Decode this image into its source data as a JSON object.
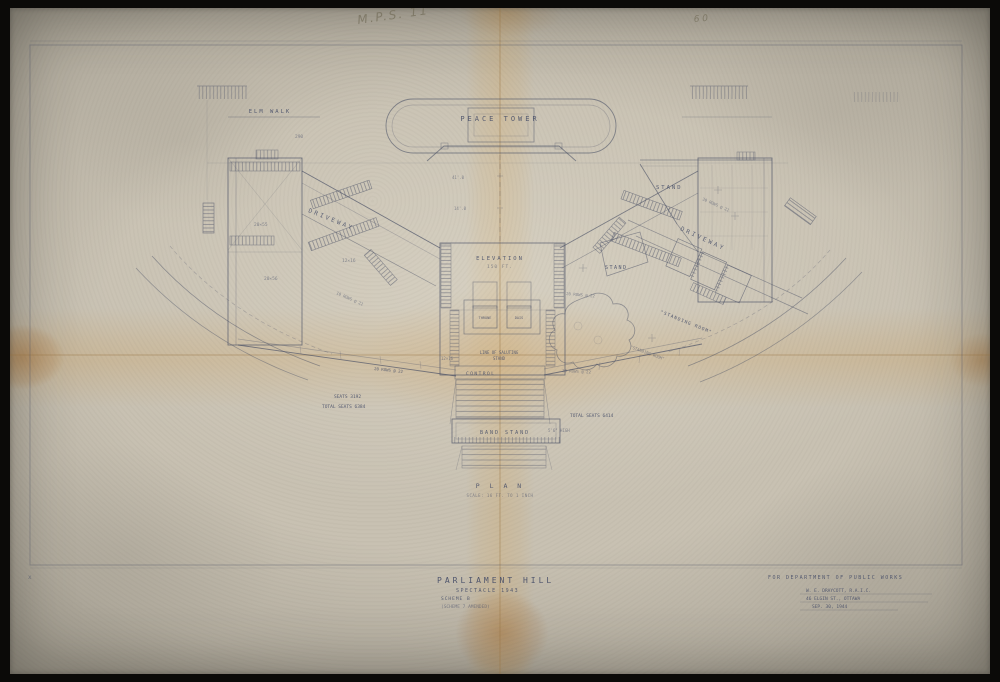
{
  "artifact": {
    "scribble_top": "M.P.S. 11",
    "scribble_top_right": "6 0",
    "x_mark": "x"
  },
  "plan": {
    "peace_tower": "PEACE TOWER",
    "elm_walk": "ELM WALK",
    "ref_290": "290",
    "dim_41": "41'.0",
    "dim_14": "14'.0",
    "elevation": "ELEVATION",
    "elevation_note": "150 FT.",
    "driveway_left": "DRIVEWAY",
    "driveway_right": "DRIVEWAY",
    "stand_right_top": "STAND",
    "stand_right_low": "STAND",
    "rows_right_top": "30 ROWS @ 22",
    "dim_20x55": "20×55",
    "dim_12x16_left": "12×16",
    "dim_20x56": "20×56",
    "rows_left_upper": "10 ROWS @ 22",
    "rows_left_lower": "20 ROWS @ 22",
    "rows_right_upper": "20 ROWS @ 22",
    "rows_right_lower": "20 ROWS @ 22",
    "standing_room_1": "\"STANDING ROOM\"",
    "standing_room_2": "\"STANDING ROOM\"",
    "throne": "THRONE",
    "dais": "DAIS",
    "saluting_line_1": "LINE OF SALUTING",
    "saluting_line_2": "STAND",
    "dim_12x16_center": "12×16",
    "control": "CONTROL",
    "band_stand": "BAND STAND",
    "band_height": "5'6\" HIGH",
    "seats_left": "SEATS 3192",
    "total_left": "TOTAL SEATS 6384",
    "total_right": "TOTAL SEATS 6414",
    "plan_label": "P L A N",
    "plan_scale": "SCALE: 16 FT. TO 1 INCH"
  },
  "title_block": {
    "title": "PARLIAMENT HILL",
    "subtitle": "SPECTACLE 1943",
    "scheme": "SCHEME B",
    "scheme_note": "(SCHEME 7 AMENDED)",
    "client": "FOR DEPARTMENT OF PUBLIC WORKS",
    "architect": "W. E. DRAYCOTT, R.A.I.C.",
    "address": "46 ELGIN ST., OTTAWA",
    "date": "SEP. 30, 1944"
  }
}
